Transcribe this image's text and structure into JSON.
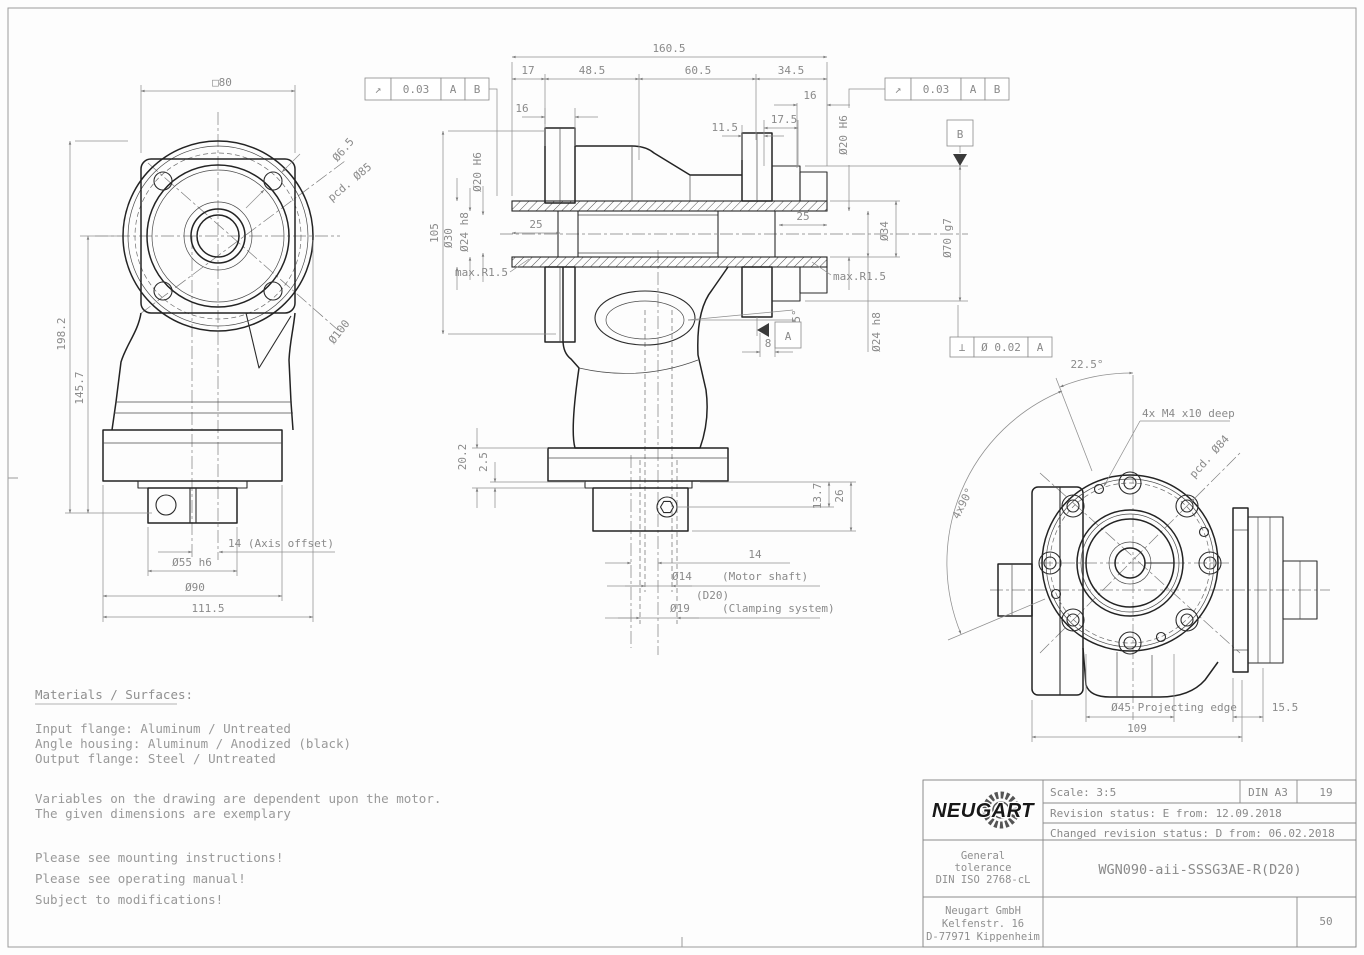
{
  "front_view": {
    "square": "□80",
    "bolt_hole": "Ø6.5",
    "pcd": "pcd. Ø85",
    "outer": "Ø100",
    "total_height": "198.2",
    "center_height": "145.7",
    "axis_offset": "14  (Axis offset)",
    "spigot": "Ø55 h6",
    "flange": "Ø90",
    "width": "111.5"
  },
  "section_view": {
    "fcf": {
      "symbol": "↗",
      "tolerance": "0.03",
      "datum1": "A",
      "datum2": "B"
    },
    "perp": {
      "symbol": "⊥",
      "tolerance": "Ø 0.02",
      "datum": "A"
    },
    "datum_a": "A",
    "datum_b": "B",
    "top": {
      "total": "160.5",
      "s17": "17",
      "s48": "48.5",
      "s60": "60.5",
      "s34": "34.5",
      "t16_left": "16",
      "t16_right": "16",
      "t17_5": "17.5",
      "t11_5": "11.5"
    },
    "left": {
      "h105": "105",
      "d20": "Ø20 H6",
      "d30": "Ø30",
      "d24": "Ø24 h8",
      "bore25": "25",
      "maxr": "max.R1.5"
    },
    "right": {
      "d20": "Ø20 H6",
      "d34": "Ø34",
      "d70": "Ø70 g7",
      "d24": "Ø24 h8",
      "bore25": "25",
      "maxr": "max.R1.5",
      "angle": "5°",
      "off8": "8"
    },
    "bottom": {
      "v20_2": "20.2",
      "v2_5": "2.5",
      "v13_7": "13.7",
      "v26": "26",
      "v14": "14",
      "motor_d": "Ø14",
      "motor_note": "(D20)",
      "motor_label": "(Motor shaft)",
      "clamp_d": "Ø19",
      "clamp_label": "(Clamping system)"
    }
  },
  "side_view": {
    "angle22": "22.5°",
    "angle90": "4x90°",
    "thread": "4x M4 x10 deep",
    "pcd": "pcd. Ø84",
    "projecting": "Ø45 Projecting edge",
    "s15_5": "15.5",
    "w109": "109"
  },
  "notes": {
    "heading": "Materials / Surfaces:",
    "materials": [
      "Input flange: Aluminum / Untreated",
      "Angle housing: Aluminum / Anodized (black)",
      "Output flange: Steel / Untreated"
    ],
    "variables": [
      "Variables on the drawing are dependent upon the motor.",
      "The given dimensions are exemplary"
    ],
    "advisories": [
      "Please see mounting instructions!",
      "Please see operating manual!",
      "Subject to modifications!"
    ]
  },
  "title_block": {
    "brand": "NEUGART",
    "scale": "Scale: 3:5",
    "format": "DIN A3",
    "sheet": "19",
    "revision": "Revision status: E   from: 12.09.2018",
    "changed": "Changed revision status: D   from: 06.02.2018",
    "tolerance": [
      "General",
      "tolerance",
      "DIN ISO 2768-cL"
    ],
    "part_number": "WGN090-aii-SSSG3AE-R(D20)",
    "company": [
      "Neugart GmbH",
      "Kelfenstr. 16",
      "D-77971 Kippenheim"
    ],
    "code": "50"
  }
}
